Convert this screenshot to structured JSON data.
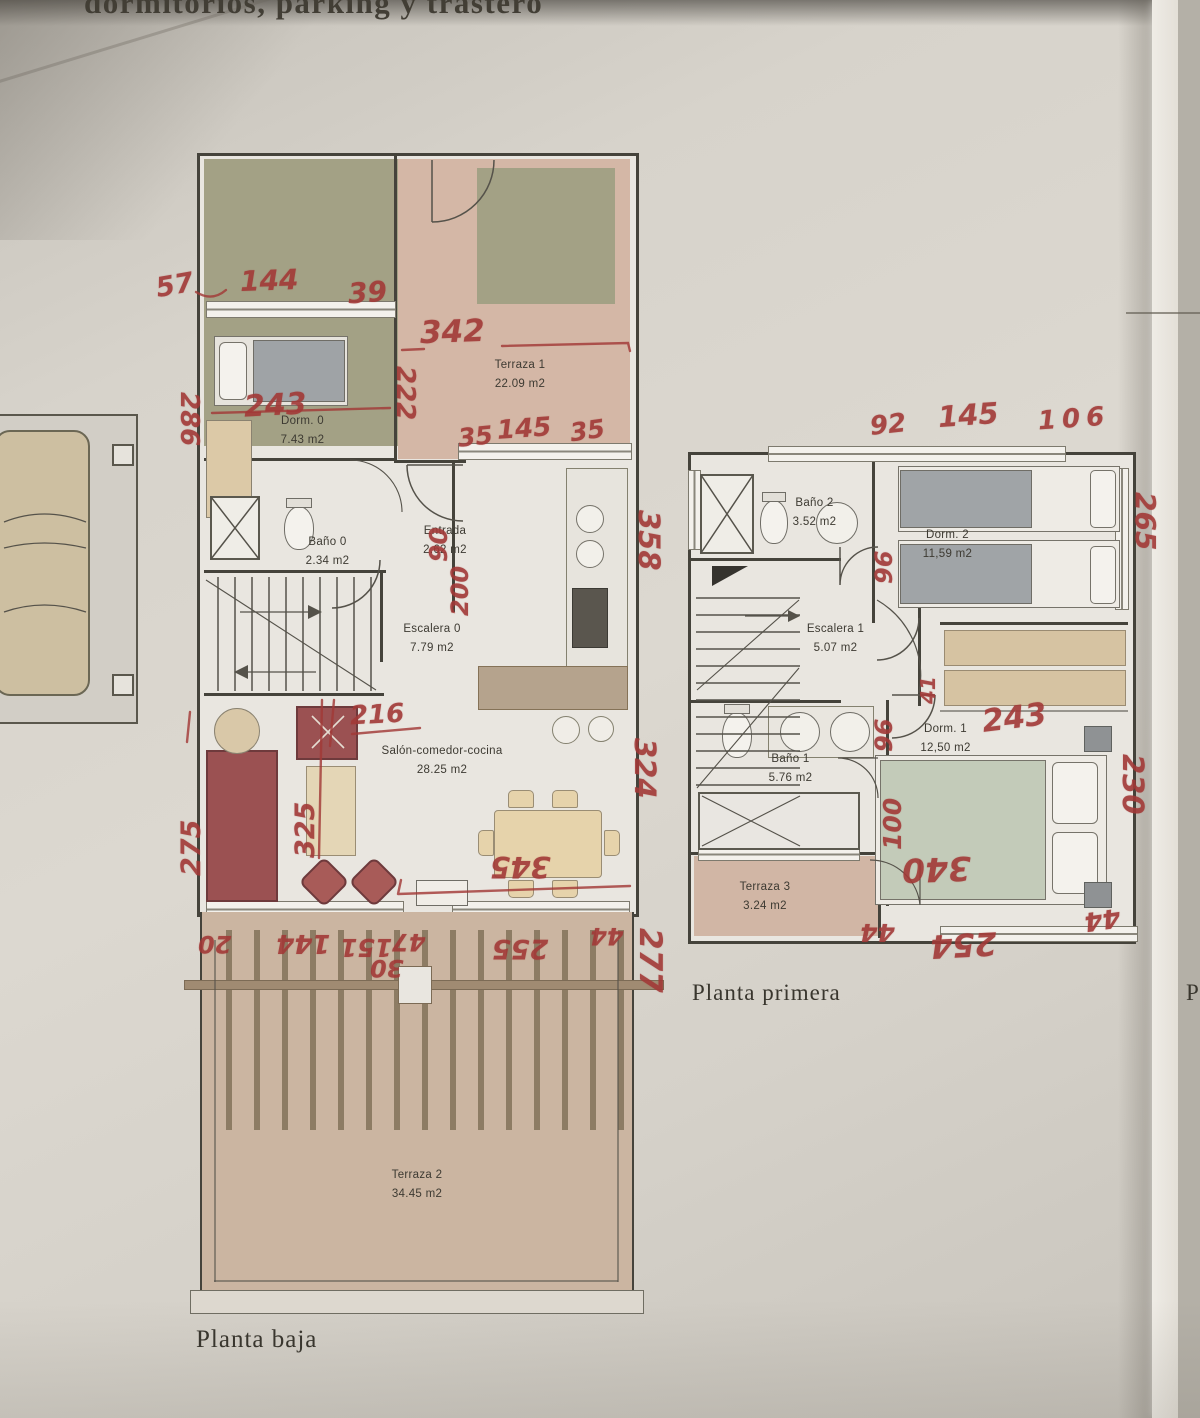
{
  "header": {
    "text": "dormitorios, parking y trastero"
  },
  "page_edge_label": "P",
  "palette": {
    "annotation_red": "#a23937",
    "paper": "#d6d2ca",
    "olive_green": "#a3a185",
    "terrace_pink": "#d4b7a6",
    "wood_tan": "#d9c6a4",
    "sofa_red": "#9b5152"
  },
  "ground_floor": {
    "caption": "Planta baja",
    "rooms": [
      {
        "name": "Terraza 1",
        "area": "22.09 m2"
      },
      {
        "name": "Dorm. 0",
        "area": "7.43 m2"
      },
      {
        "name": "Baño 0",
        "area": "2.34 m2"
      },
      {
        "name": "Entrada",
        "area": "2.62 m2"
      },
      {
        "name": "Escalera 0",
        "area": "7.79 m2"
      },
      {
        "name": "Salón-comedor-cocina",
        "area": "28.25 m2"
      },
      {
        "name": "Terraza 2",
        "area": "34.45 m2"
      }
    ],
    "measurements": [
      {
        "value": "57"
      },
      {
        "value": "144"
      },
      {
        "value": "39"
      },
      {
        "value": "342"
      },
      {
        "value": "222"
      },
      {
        "value": "286"
      },
      {
        "value": "243"
      },
      {
        "value": "35"
      },
      {
        "value": "145"
      },
      {
        "value": "35"
      },
      {
        "value": "90"
      },
      {
        "value": "200"
      },
      {
        "value": "216"
      },
      {
        "value": "358"
      },
      {
        "value": "325"
      },
      {
        "value": "275"
      },
      {
        "value": "345"
      },
      {
        "value": "324"
      },
      {
        "value": "20"
      },
      {
        "value": "144"
      },
      {
        "value": "151"
      },
      {
        "value": "47"
      },
      {
        "value": "30"
      },
      {
        "value": "255"
      },
      {
        "value": "44"
      },
      {
        "value": "277"
      }
    ]
  },
  "first_floor": {
    "caption": "Planta primera",
    "rooms": [
      {
        "name": "Baño 2",
        "area": "3.52 m2"
      },
      {
        "name": "Dorm. 2",
        "area": "11,59 m2"
      },
      {
        "name": "Escalera 1",
        "area": "5.07 m2"
      },
      {
        "name": "Dorm. 1",
        "area": "12,50 m2"
      },
      {
        "name": "Baño 1",
        "area": "5.76 m2"
      },
      {
        "name": "Terraza 3",
        "area": "3.24 m2"
      }
    ],
    "measurements": [
      {
        "value": "92"
      },
      {
        "value": "145"
      },
      {
        "value": "106"
      },
      {
        "value": "265"
      },
      {
        "value": "96"
      },
      {
        "value": "41"
      },
      {
        "value": "96"
      },
      {
        "value": "100"
      },
      {
        "value": "243"
      },
      {
        "value": "230"
      },
      {
        "value": "340"
      },
      {
        "value": "44"
      },
      {
        "value": "254"
      },
      {
        "value": "44"
      }
    ]
  }
}
